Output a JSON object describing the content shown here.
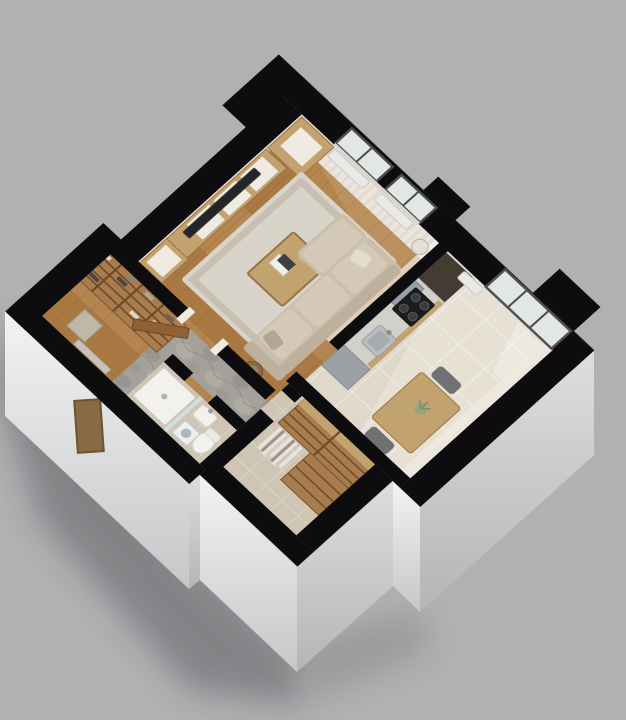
{
  "title": "Isometric 3D cutaway floor plan of a one-bedroom apartment",
  "colors": {
    "background": "#b0b1b3",
    "ground_shadow": "#26282a",
    "wall_cut": "#0d0d0f",
    "face_bright": "#f3f3f4",
    "face_mid": "#dddee0",
    "face_dark": "#c6c7c9",
    "face_deep": "#b4b5b7",
    "interior_wall": "#efe9df",
    "wood_floor": "#b5854f",
    "wood_floor_alt": "#aa7943",
    "wood_floor_line": "#8d6336",
    "wood_furniture": "#c2a26f",
    "wood_dark": "#8f6134",
    "wood_shelf": "#a87c4e",
    "shelf_line": "#6e4c2a",
    "rug": "#d9d4ca",
    "rug_border": "#c7c0b2",
    "sofa": "#cabead",
    "cushion": "#d4c8b6",
    "sofa_dark": "#bdb09d",
    "tv_screen": "#232527",
    "counter_top": "#d2d0cb",
    "cooktop": "#1b1c1e",
    "burner": "#3b3c3e",
    "steel": "#9aa0a3",
    "dark_unit": "#443b33",
    "tile_kitchen": "#e0d8ca",
    "tile_grout": "#f1ece2",
    "tile_bath": "#cfc5b5",
    "tile_bath_grout": "#e4dbc9",
    "stone": "#a3a19a",
    "stone_dark": "#8f8d86",
    "glass": "#cfe3e8",
    "window_glass": "#e3e6e7",
    "frame_dark": "#4a4c4e",
    "white_fixture": "#f2f1ee",
    "fixture_edge": "#d3d1cb",
    "radiator": "#e9e9e7",
    "curtain": "#f6f4f0",
    "plant": "#9aa57e",
    "chair": "#6f7173",
    "white_front": "#efeae2",
    "sunlight": "#ffffff"
  },
  "scene": {
    "view": "axonometric dollhouse cutaway, walls sliced black at top, white exterior faces, soft drop shadow on gray ground",
    "rooms": [
      {
        "name": "living-room",
        "floor": "oak-plank",
        "furniture": [
          "media-console",
          "tv",
          "tall-shelf-unit",
          "sideboard",
          "area-rug",
          "coffee-table",
          "l-shaped-sofa",
          "side-table",
          "floor-lamp",
          "curtains",
          "double-window",
          "radiators"
        ]
      },
      {
        "name": "kitchen-dining",
        "floor": "beige-tile",
        "furniture": [
          "tall-dark-cabinet",
          "extractor-hood",
          "cooktop",
          "counter-run",
          "sink",
          "steel-base-unit",
          "balcony-door",
          "radiator",
          "dining-table",
          "two-chairs",
          "table-plant"
        ]
      },
      {
        "name": "entry-hall",
        "floor": "oak-and-slate",
        "furniture": [
          "open-entrance-door",
          "slate-entry-mat"
        ]
      },
      {
        "name": "wardrobe-room",
        "floor": "oak-plank",
        "furniture": [
          "shoe-shelf-unit",
          "glass-side-table",
          "wall-mirror"
        ]
      },
      {
        "name": "bathroom",
        "floor": "taupe-tile",
        "furniture": [
          "shower-tray",
          "glass-screen",
          "pedestal-sink",
          "toilet",
          "laundry-unit"
        ]
      },
      {
        "name": "walk-in-closet",
        "floor": "taupe-tile",
        "furniture": [
          "wardrobe-shelves",
          "hanging-rail",
          "wardrobe-top-panel"
        ]
      }
    ]
  }
}
